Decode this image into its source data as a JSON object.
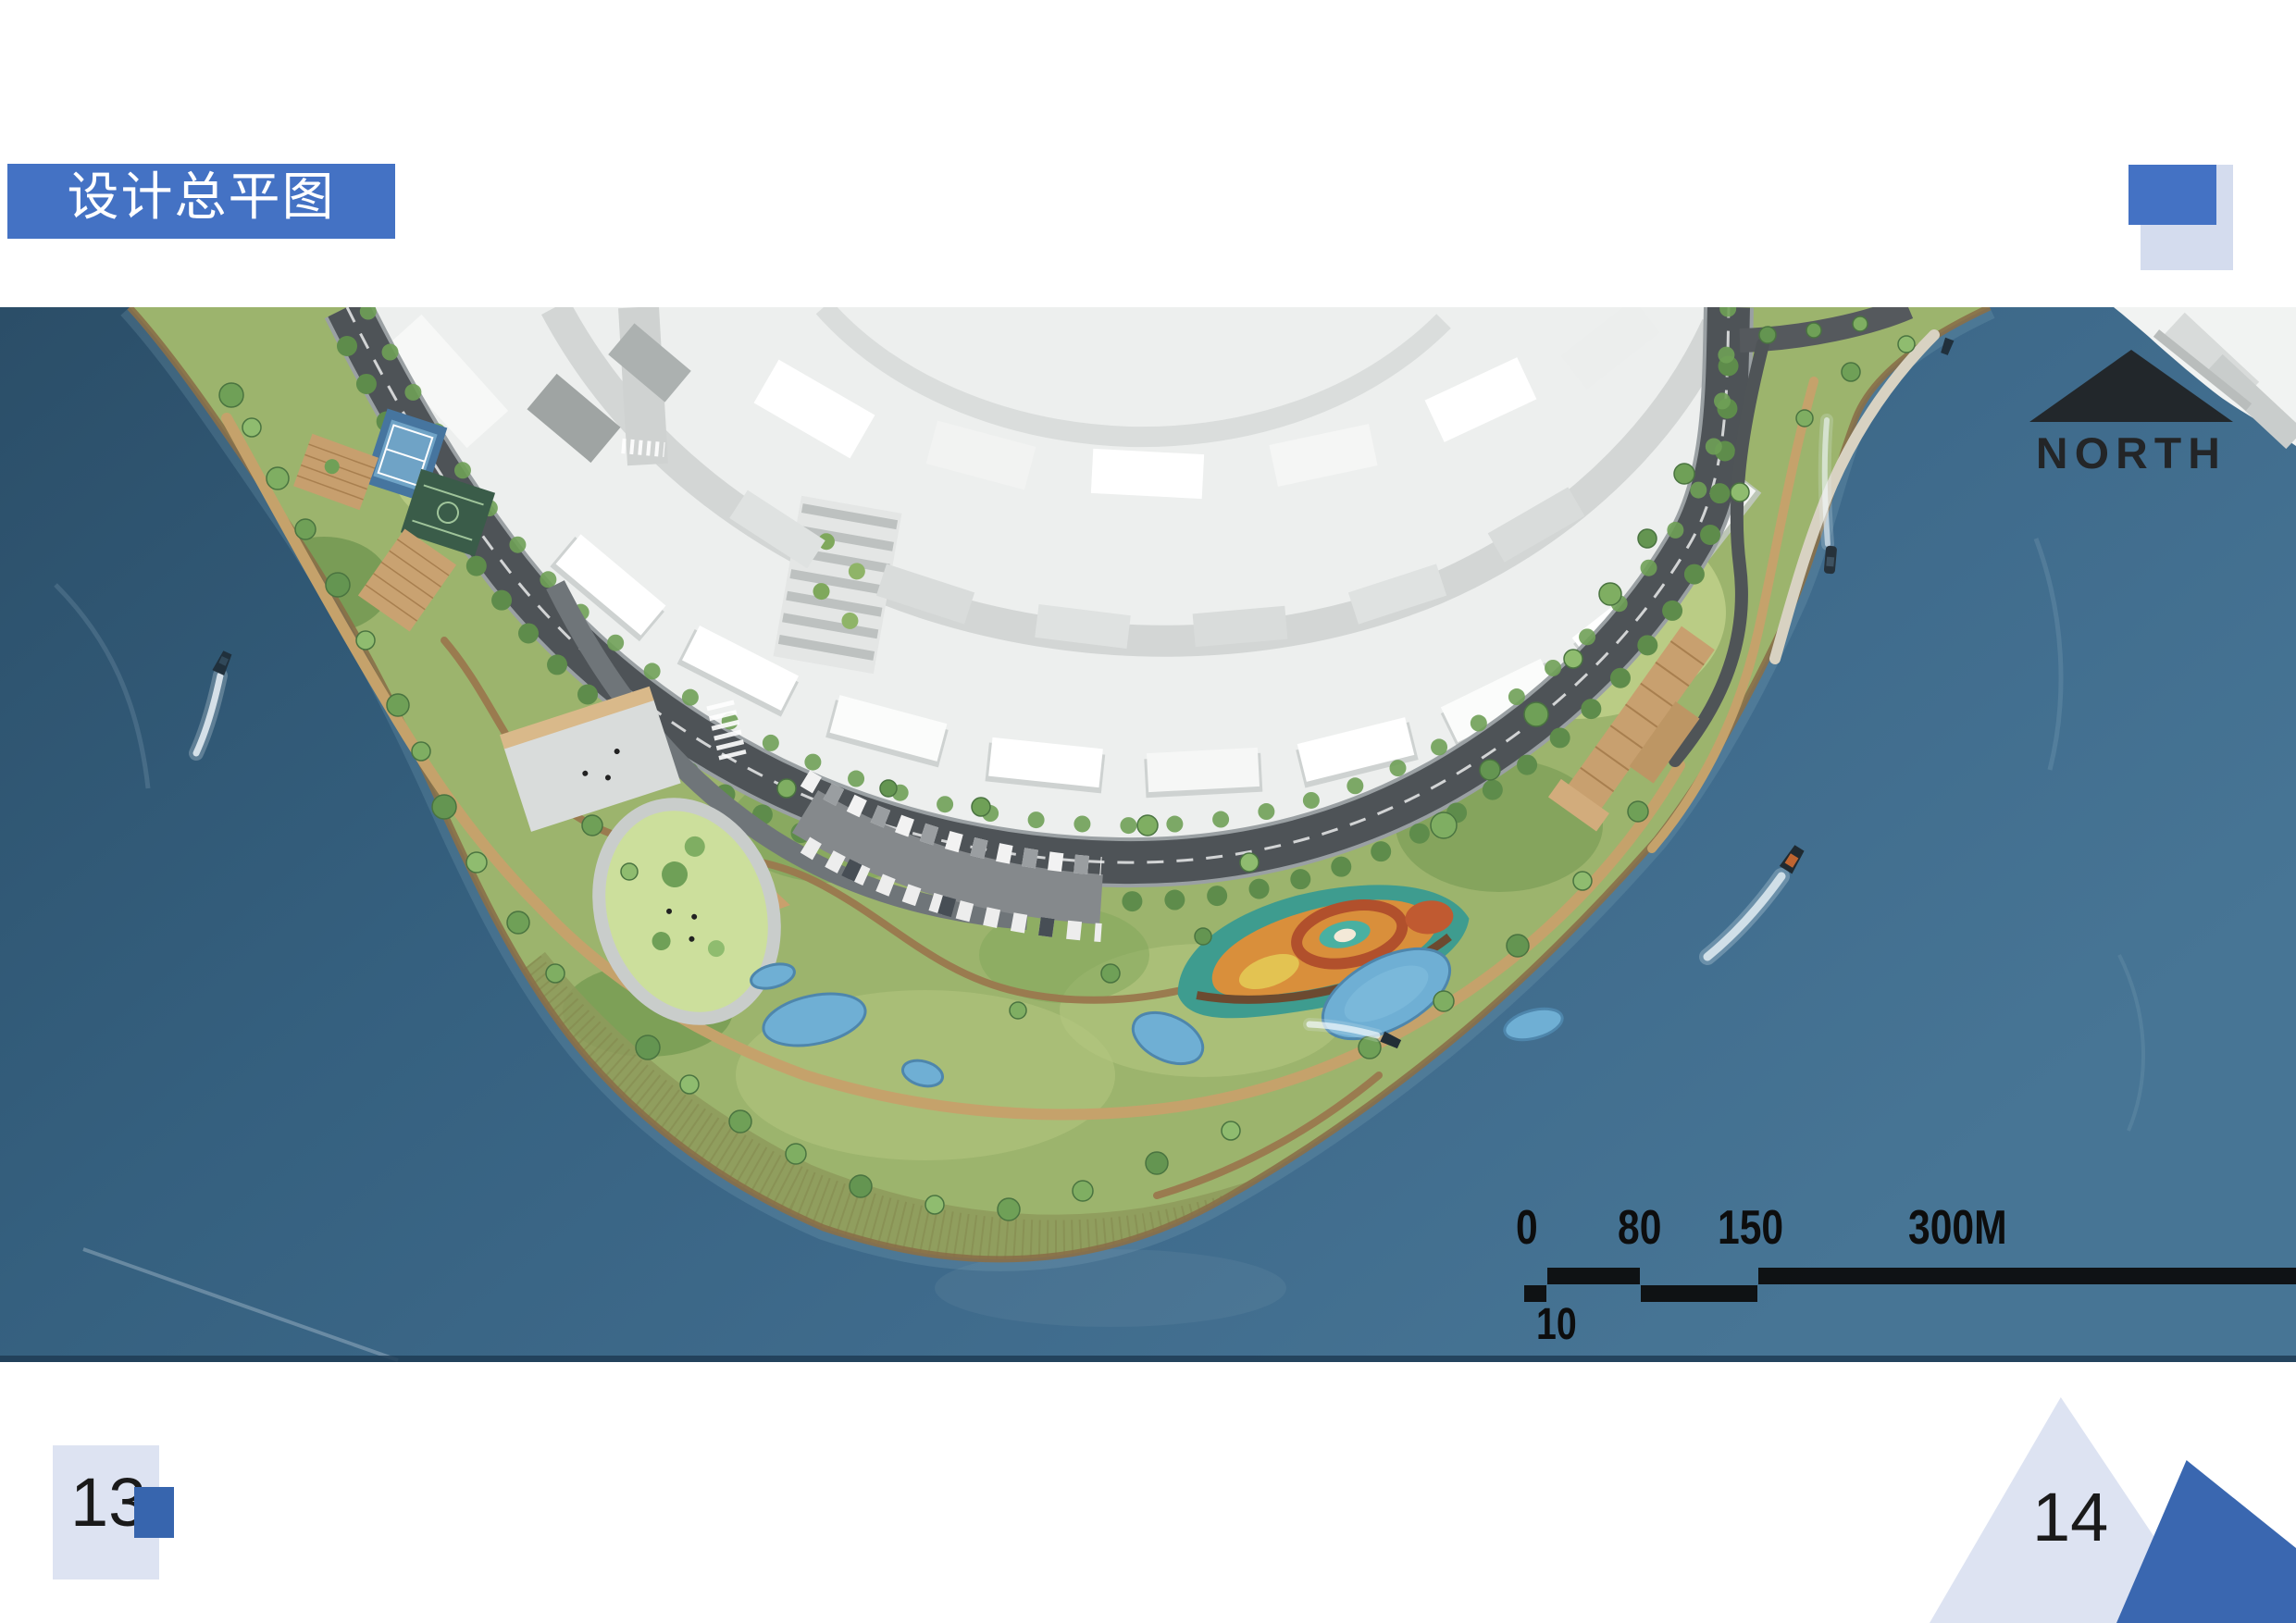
{
  "slide": {
    "title": "设计总平图",
    "page_left": "13",
    "page_right": "14"
  },
  "map": {
    "north_label": "NORTH",
    "scale": {
      "tick0": "0",
      "tick1": "80",
      "tick2": "150",
      "tick3": "300M",
      "sub_tick": "10"
    }
  },
  "colors": {
    "accent_blue": "#4472C4",
    "light_blue_decor": "#DDE3F2",
    "dark_blue_decor": "#3765AE",
    "water_deep": "#2B4E68",
    "water_light": "#477595",
    "park_green": "#9CB46D",
    "road_dark": "#4E5357",
    "city_white": "#EDEFEE",
    "pond_blue": "#6FAFD4",
    "deck_tan": "#C79F6E"
  }
}
